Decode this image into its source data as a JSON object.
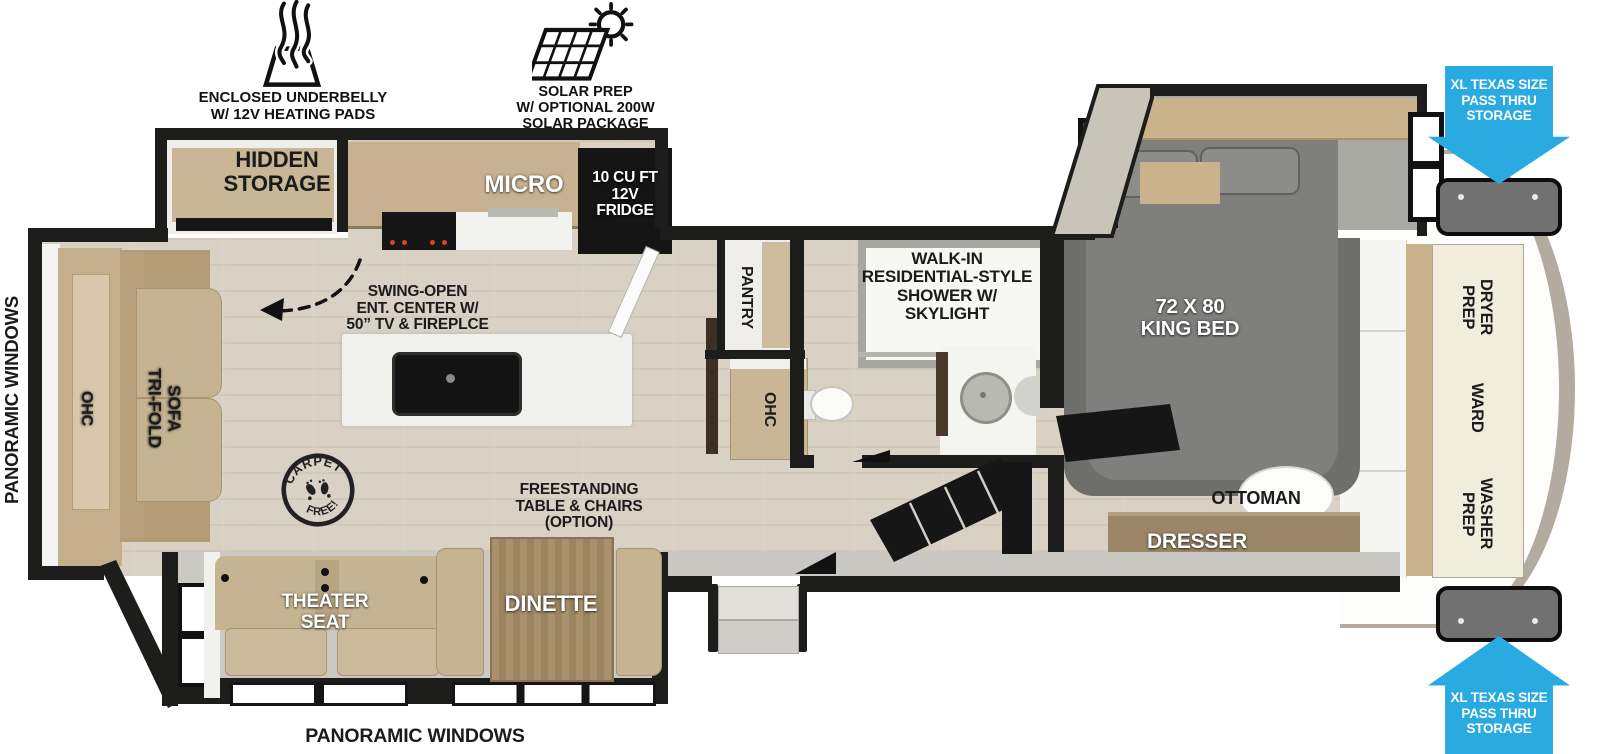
{
  "colors": {
    "wall": "#1d1d1b",
    "floor": "#d8d1c4",
    "trim": "#c9c8c3",
    "wood": "#c8b190",
    "wood-dark": "#a8906c",
    "sofa": "#c6b392",
    "slide-floor": "#cac9c3",
    "bed": "#7f7f7d",
    "rug": "#6e6e6c",
    "island": "#f0f0ed",
    "appliance": "#151515",
    "cap": "#b3aaa0",
    "cream": "#f1ecdc",
    "storage-box": "#717171",
    "arrow-blue": "#29abe2"
  },
  "icons": {
    "underbelly_label": "ENCLOSED UNDERBELLY\nW/ 12V HEATING PADS",
    "solar_label": "SOLAR PREP\nW/ OPTIONAL 200W\nSOLAR PACKAGE"
  },
  "plan": {
    "hidden_storage": "HIDDEN\nSTORAGE",
    "micro": "MICRO",
    "fridge": "10 CU FT\n12V\nFRIDGE",
    "swing_open": "SWING-OPEN\nENT. CENTER W/\n50” TV & FIREPLCE",
    "pantry": "PANTRY",
    "ohc_mid": "OHC",
    "shower": "WALK-IN\nRESIDENTIAL-STYLE\nSHOWER W/\nSKYLIGHT",
    "king_bed": "72 X 80\nKING BED",
    "ottoman": "OTTOMAN",
    "dresser": "DRESSER",
    "dryer_prep": "DRYER\nPREP",
    "ward": "WARD",
    "washer_prep": "WASHER\nPREP",
    "ohc_rear": "OHC",
    "tri_fold_sofa": "TRI-FOLD\nSOFA",
    "carpet_top": "CARPET",
    "carpet_bottom": "FREE!",
    "freestanding": "FREESTANDING\nTABLE & CHAIRS\n(OPTION)",
    "theater_seat": "THEATER\nSEAT",
    "dinette": "DINETTE",
    "panoramic_left": "PANORAMIC WINDOWS",
    "panoramic_bottom": "PANORAMIC WINDOWS",
    "pass_thru_top": "XL TEXAS SIZE\nPASS THRU\nSTORAGE",
    "pass_thru_bottom": "XL TEXAS SIZE\nPASS THRU\nSTORAGE"
  }
}
